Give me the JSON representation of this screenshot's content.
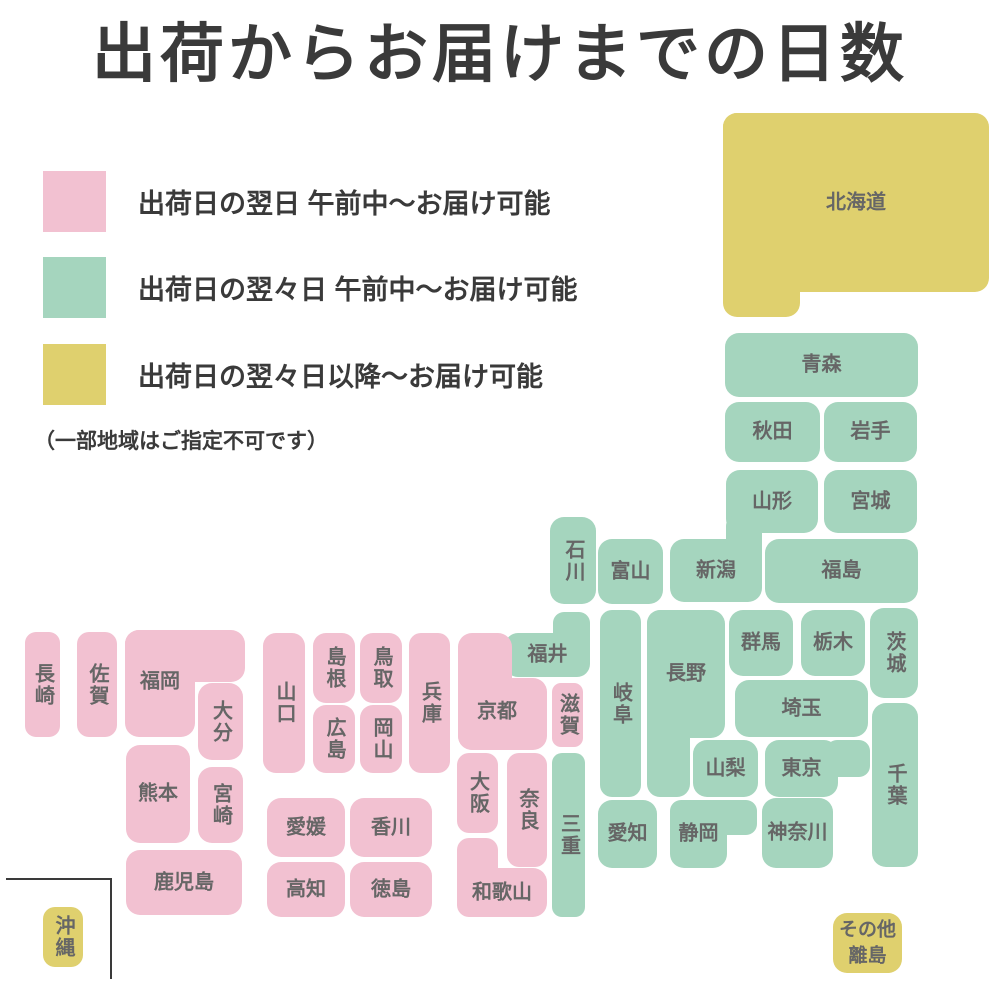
{
  "title": "出荷からお届けまでの日数",
  "legend": {
    "items": [
      {
        "color_key": "pink",
        "label": "出荷日の翌日 午前中〜お届け可能"
      },
      {
        "color_key": "green",
        "label": "出荷日の翌々日 午前中〜お届け可能"
      },
      {
        "color_key": "yellow",
        "label": "出荷日の翌々日以降〜お届け可能"
      }
    ],
    "note": "（一部地域はご指定不可です）"
  },
  "colors": {
    "pink": "#F2C1D1",
    "green": "#A5D5BE",
    "yellow": "#DFD06E",
    "label_text": "#666666",
    "heading_text": "#3A3A3A",
    "background": "#FFFFFF",
    "okinawa_border": "#3A3A3A"
  },
  "map": {
    "prefectures": [
      {
        "id": "hokkaido",
        "name": "北海道",
        "color": "yellow",
        "dir": "h",
        "parts": [
          [
            723,
            113,
            266,
            179
          ],
          [
            723,
            113,
            77,
            204
          ]
        ]
      },
      {
        "id": "aomori",
        "name": "青森",
        "color": "green",
        "dir": "h",
        "parts": [
          [
            725,
            333,
            193,
            64
          ]
        ]
      },
      {
        "id": "akita",
        "name": "秋田",
        "color": "green",
        "dir": "h",
        "parts": [
          [
            725,
            402,
            95,
            60
          ]
        ]
      },
      {
        "id": "iwate",
        "name": "岩手",
        "color": "green",
        "dir": "h",
        "parts": [
          [
            824,
            402,
            93,
            60
          ]
        ]
      },
      {
        "id": "yamagata",
        "name": "山形",
        "color": "green",
        "dir": "h",
        "parts": [
          [
            726,
            470,
            92,
            63
          ]
        ]
      },
      {
        "id": "miyagi",
        "name": "宮城",
        "color": "green",
        "dir": "h",
        "parts": [
          [
            824,
            470,
            93,
            63
          ]
        ]
      },
      {
        "id": "niigata",
        "name": "新潟",
        "color": "green",
        "dir": "h",
        "parts": [
          [
            670,
            539,
            92,
            63
          ],
          [
            726,
            515,
            36,
            60
          ]
        ]
      },
      {
        "id": "fukushima",
        "name": "福島",
        "color": "green",
        "dir": "h",
        "parts": [
          [
            765,
            539,
            153,
            64
          ]
        ]
      },
      {
        "id": "ishikawa",
        "name": "石川",
        "color": "green",
        "dir": "v",
        "parts": [
          [
            550,
            517,
            46,
            87
          ]
        ]
      },
      {
        "id": "toyama",
        "name": "富山",
        "color": "green",
        "dir": "h",
        "parts": [
          [
            598,
            539,
            65,
            65
          ]
        ]
      },
      {
        "id": "fukui",
        "name": "福井",
        "color": "green",
        "dir": "h",
        "parts": [
          [
            505,
            633,
            85,
            44
          ],
          [
            553,
            612,
            37,
            45
          ]
        ]
      },
      {
        "id": "gunma",
        "name": "群馬",
        "color": "green",
        "dir": "h",
        "parts": [
          [
            729,
            610,
            64,
            66
          ]
        ]
      },
      {
        "id": "tochigi",
        "name": "栃木",
        "color": "green",
        "dir": "h",
        "parts": [
          [
            801,
            610,
            64,
            66
          ]
        ]
      },
      {
        "id": "ibaraki",
        "name": "茨城",
        "color": "green",
        "dir": "v",
        "parts": [
          [
            870,
            608,
            48,
            90
          ]
        ]
      },
      {
        "id": "saitama",
        "name": "埼玉",
        "color": "green",
        "dir": "h",
        "parts": [
          [
            735,
            680,
            133,
            57
          ]
        ]
      },
      {
        "id": "chiba",
        "name": "千葉",
        "color": "green",
        "dir": "v",
        "parts": [
          [
            872,
            703,
            46,
            164
          ]
        ]
      },
      {
        "id": "tokyo",
        "name": "東京",
        "color": "green",
        "dir": "h",
        "parts": [
          [
            765,
            740,
            73,
            57
          ],
          [
            826,
            740,
            44,
            37
          ]
        ]
      },
      {
        "id": "kanagawa",
        "name": "神奈川",
        "color": "green",
        "dir": "h",
        "parts": [
          [
            762,
            798,
            71,
            70
          ]
        ]
      },
      {
        "id": "yamanashi",
        "name": "山梨",
        "color": "green",
        "dir": "h",
        "parts": [
          [
            693,
            740,
            65,
            57
          ]
        ]
      },
      {
        "id": "nagano",
        "name": "長野",
        "color": "green",
        "dir": "h",
        "parts": [
          [
            647,
            610,
            78,
            128
          ],
          [
            647,
            610,
            43,
            187
          ]
        ]
      },
      {
        "id": "gifu",
        "name": "岐阜",
        "color": "green",
        "dir": "v",
        "parts": [
          [
            600,
            610,
            41,
            187
          ]
        ]
      },
      {
        "id": "shizuoka",
        "name": "静岡",
        "color": "green",
        "dir": "h",
        "parts": [
          [
            670,
            800,
            57,
            68
          ],
          [
            670,
            800,
            87,
            35
          ]
        ]
      },
      {
        "id": "aichi",
        "name": "愛知",
        "color": "green",
        "dir": "h",
        "parts": [
          [
            598,
            800,
            59,
            68
          ]
        ]
      },
      {
        "id": "mie",
        "name": "三重",
        "color": "green",
        "dir": "v",
        "parts": [
          [
            552,
            753,
            33,
            164
          ]
        ]
      },
      {
        "id": "shiga",
        "name": "滋賀",
        "color": "pink",
        "dir": "v",
        "parts": [
          [
            552,
            683,
            31,
            64
          ]
        ]
      },
      {
        "id": "kyoto",
        "name": "京都",
        "color": "pink",
        "dir": "h",
        "parts": [
          [
            458,
            633,
            54,
            117
          ],
          [
            458,
            678,
            89,
            72
          ]
        ],
        "label_at": [
          497,
          712
        ]
      },
      {
        "id": "osaka",
        "name": "大阪",
        "color": "pink",
        "dir": "v",
        "parts": [
          [
            457,
            753,
            41,
            80
          ]
        ]
      },
      {
        "id": "nara",
        "name": "奈良",
        "color": "pink",
        "dir": "v",
        "parts": [
          [
            507,
            753,
            40,
            114
          ]
        ]
      },
      {
        "id": "wakayama",
        "name": "和歌山",
        "color": "pink",
        "dir": "h",
        "parts": [
          [
            457,
            868,
            90,
            49
          ],
          [
            457,
            838,
            41,
            79
          ]
        ]
      },
      {
        "id": "hyogo",
        "name": "兵庫",
        "color": "pink",
        "dir": "v",
        "parts": [
          [
            409,
            633,
            41,
            140
          ]
        ]
      },
      {
        "id": "tottori",
        "name": "鳥取",
        "color": "pink",
        "dir": "v",
        "parts": [
          [
            360,
            633,
            42,
            70
          ]
        ]
      },
      {
        "id": "okayama",
        "name": "岡山",
        "color": "pink",
        "dir": "v",
        "parts": [
          [
            360,
            705,
            42,
            68
          ]
        ]
      },
      {
        "id": "shimane",
        "name": "島根",
        "color": "pink",
        "dir": "v",
        "parts": [
          [
            313,
            633,
            42,
            70
          ]
        ]
      },
      {
        "id": "hiroshima",
        "name": "広島",
        "color": "pink",
        "dir": "v",
        "parts": [
          [
            313,
            705,
            42,
            68
          ]
        ]
      },
      {
        "id": "yamaguchi",
        "name": "山口",
        "color": "pink",
        "dir": "v",
        "parts": [
          [
            263,
            633,
            42,
            140
          ]
        ]
      },
      {
        "id": "kagawa",
        "name": "香川",
        "color": "pink",
        "dir": "h",
        "parts": [
          [
            350,
            798,
            82,
            59
          ]
        ]
      },
      {
        "id": "ehime",
        "name": "愛媛",
        "color": "pink",
        "dir": "h",
        "parts": [
          [
            267,
            798,
            78,
            59
          ]
        ]
      },
      {
        "id": "kochi",
        "name": "高知",
        "color": "pink",
        "dir": "h",
        "parts": [
          [
            267,
            862,
            78,
            55
          ]
        ]
      },
      {
        "id": "tokushima",
        "name": "徳島",
        "color": "pink",
        "dir": "h",
        "parts": [
          [
            350,
            862,
            82,
            55
          ]
        ]
      },
      {
        "id": "fukuoka",
        "name": "福岡",
        "color": "pink",
        "dir": "h",
        "parts": [
          [
            125,
            630,
            120,
            52
          ],
          [
            125,
            630,
            70,
            107
          ]
        ],
        "label_at": [
          160,
          682
        ]
      },
      {
        "id": "oita",
        "name": "大分",
        "color": "pink",
        "dir": "v",
        "parts": [
          [
            198,
            683,
            45,
            77
          ]
        ]
      },
      {
        "id": "saga",
        "name": "佐賀",
        "color": "pink",
        "dir": "v",
        "parts": [
          [
            77,
            632,
            40,
            105
          ]
        ]
      },
      {
        "id": "nagasaki",
        "name": "長崎",
        "color": "pink",
        "dir": "v",
        "parts": [
          [
            25,
            632,
            35,
            105
          ]
        ]
      },
      {
        "id": "kumamoto",
        "name": "熊本",
        "color": "pink",
        "dir": "h",
        "parts": [
          [
            126,
            745,
            64,
            98
          ]
        ]
      },
      {
        "id": "miyazaki",
        "name": "宮崎",
        "color": "pink",
        "dir": "v",
        "parts": [
          [
            198,
            767,
            45,
            76
          ]
        ]
      },
      {
        "id": "kagoshima",
        "name": "鹿児島",
        "color": "pink",
        "dir": "h",
        "parts": [
          [
            126,
            850,
            116,
            65
          ]
        ]
      },
      {
        "id": "okinawa",
        "name": "沖縄",
        "color": "yellow",
        "dir": "v",
        "parts": [
          [
            43,
            907,
            40,
            60
          ]
        ]
      },
      {
        "id": "other-islands",
        "name": "その他\n離島",
        "color": "yellow",
        "dir": "h",
        "size": 19,
        "parts": [
          [
            833,
            913,
            69,
            60
          ]
        ]
      }
    ]
  }
}
